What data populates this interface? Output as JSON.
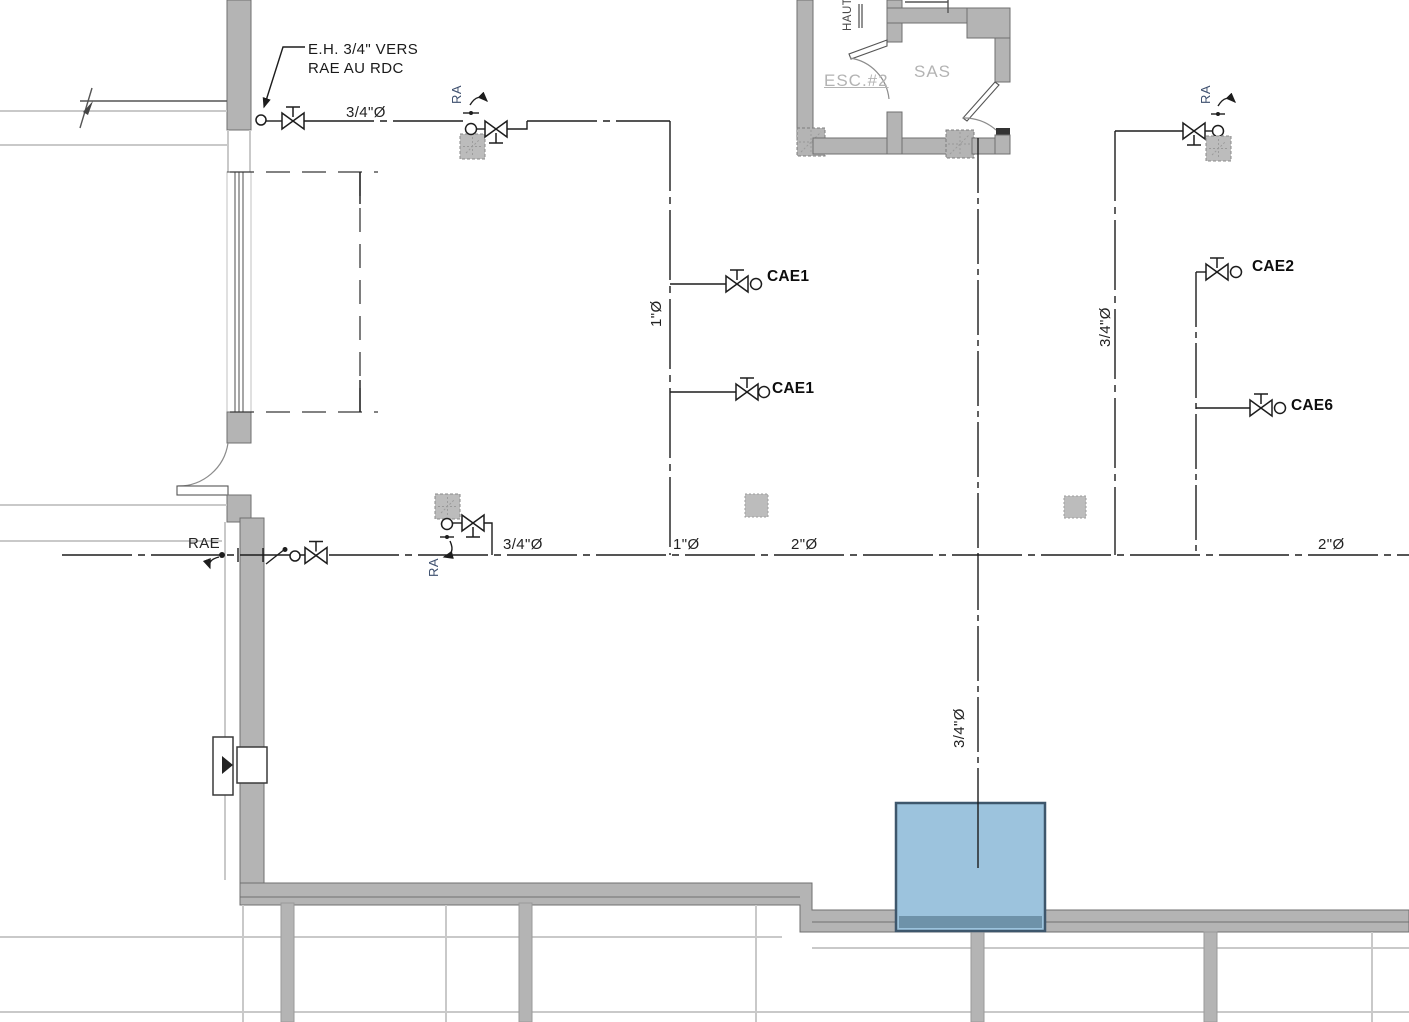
{
  "drawing": {
    "annotations": {
      "eh_note_line1": "E.H. 3/4\" VERS",
      "eh_note_line2": "RAE AU RDC",
      "rae": "RAE"
    },
    "valve_tags": {
      "ra_top_left": "RA",
      "ra_mid": "RA",
      "ra_top_right": "RA"
    },
    "pipes": {
      "top_diameter": "3/4\"Ø",
      "mid_left_diameter": "3/4\"Ø",
      "left_riser_diameter": "1\"Ø",
      "main_segment_1": "1\"Ø",
      "main_segment_2": "2\"Ø",
      "main_segment_2_right": "2\"Ø",
      "right_riser_diameter": "3/4\"Ø",
      "bottom_riser_diameter": "3/4\"Ø"
    },
    "equipment": {
      "cae1_a": "CAE1",
      "cae1_b": "CAE1",
      "cae2": "CAE2",
      "cae6": "CAE6"
    },
    "rooms": {
      "esc": "ESC.#2",
      "sas": "SAS",
      "stair_direction": "HAUT"
    },
    "colors": {
      "wall": "#b4b4b4",
      "wall_edge": "#6f6f6f",
      "light_line": "#c9c9c9",
      "line": "#1d1d1d",
      "room_text": "#b3b3b3",
      "ra_text": "#3d4f6e",
      "box_fill": "#9cc3dd",
      "box_border": "#3e576c",
      "box_band": "#6e92a9"
    }
  }
}
